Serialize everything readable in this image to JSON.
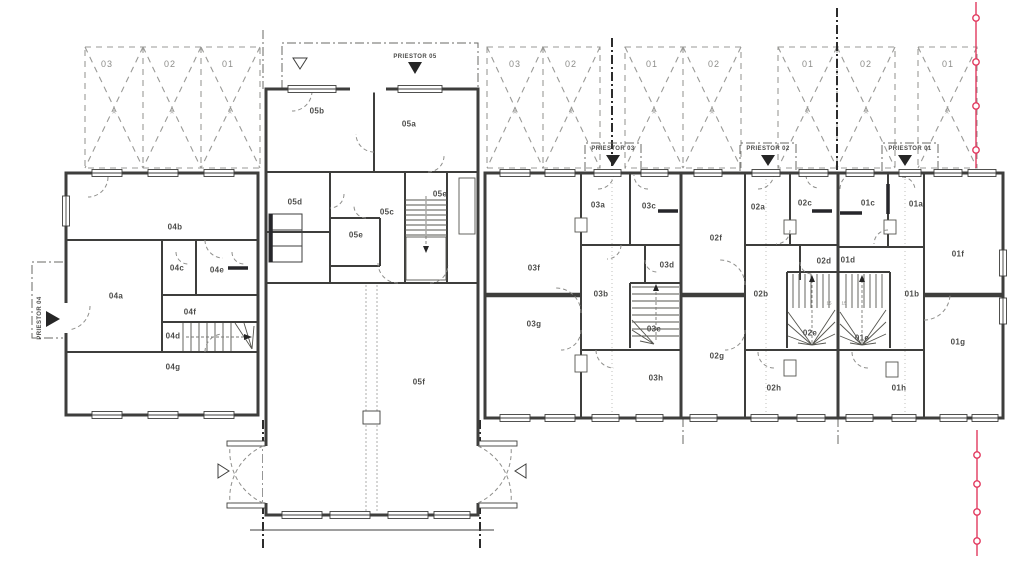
{
  "colors": {
    "unit01": "#b2e773",
    "unit02": "#f6dacc",
    "unit03": "#e2ec97",
    "unit04": "#d9f0e6",
    "unit05": "#d6e8ba",
    "wall": "#3e3e3c",
    "boundary_red": "#e23a5f"
  },
  "rooms": {
    "r04a": "04a",
    "r04b": "04b",
    "r04c": "04c",
    "r04d": "04d",
    "r04e": "04e",
    "r04f": "04f",
    "r04g": "04g",
    "r05a": "05a",
    "r05b": "05b",
    "r05c": "05c",
    "r05d": "05d",
    "r05e1": "05e",
    "r05e2": "05e",
    "r05f": "05f",
    "r03a": "03a",
    "r03b": "03b",
    "r03c": "03c",
    "r03d": "03d",
    "r03e": "03e",
    "r03f": "03f",
    "r03g": "03g",
    "r03h": "03h",
    "r02a": "02a",
    "r02b": "02b",
    "r02c": "02c",
    "r02d": "02d",
    "r02e": "02e",
    "r02f": "02f",
    "r02g": "02g",
    "r02h": "02h",
    "r01a": "01a",
    "r01b": "01b",
    "r01c": "01c",
    "r01d": "01d",
    "r01e": "01e",
    "r01f": "01f",
    "r01g": "01g",
    "r01h": "01h"
  },
  "parking": {
    "g1": [
      "03",
      "02",
      "01"
    ],
    "g2": [
      "03",
      "02"
    ],
    "g3": [
      "01",
      "02"
    ],
    "g4": [
      "01",
      "02"
    ],
    "g5": [
      "01"
    ]
  },
  "parking_mark": "x",
  "priestor": {
    "p01": "PRIESTOR 01",
    "p02": "PRIESTOR 02",
    "p03": "PRIESTOR 03",
    "p04": "PRIESTOR 04",
    "p05": "PRIESTOR 05"
  },
  "stair_numbers": {
    "n1": "15",
    "n2": "15"
  }
}
